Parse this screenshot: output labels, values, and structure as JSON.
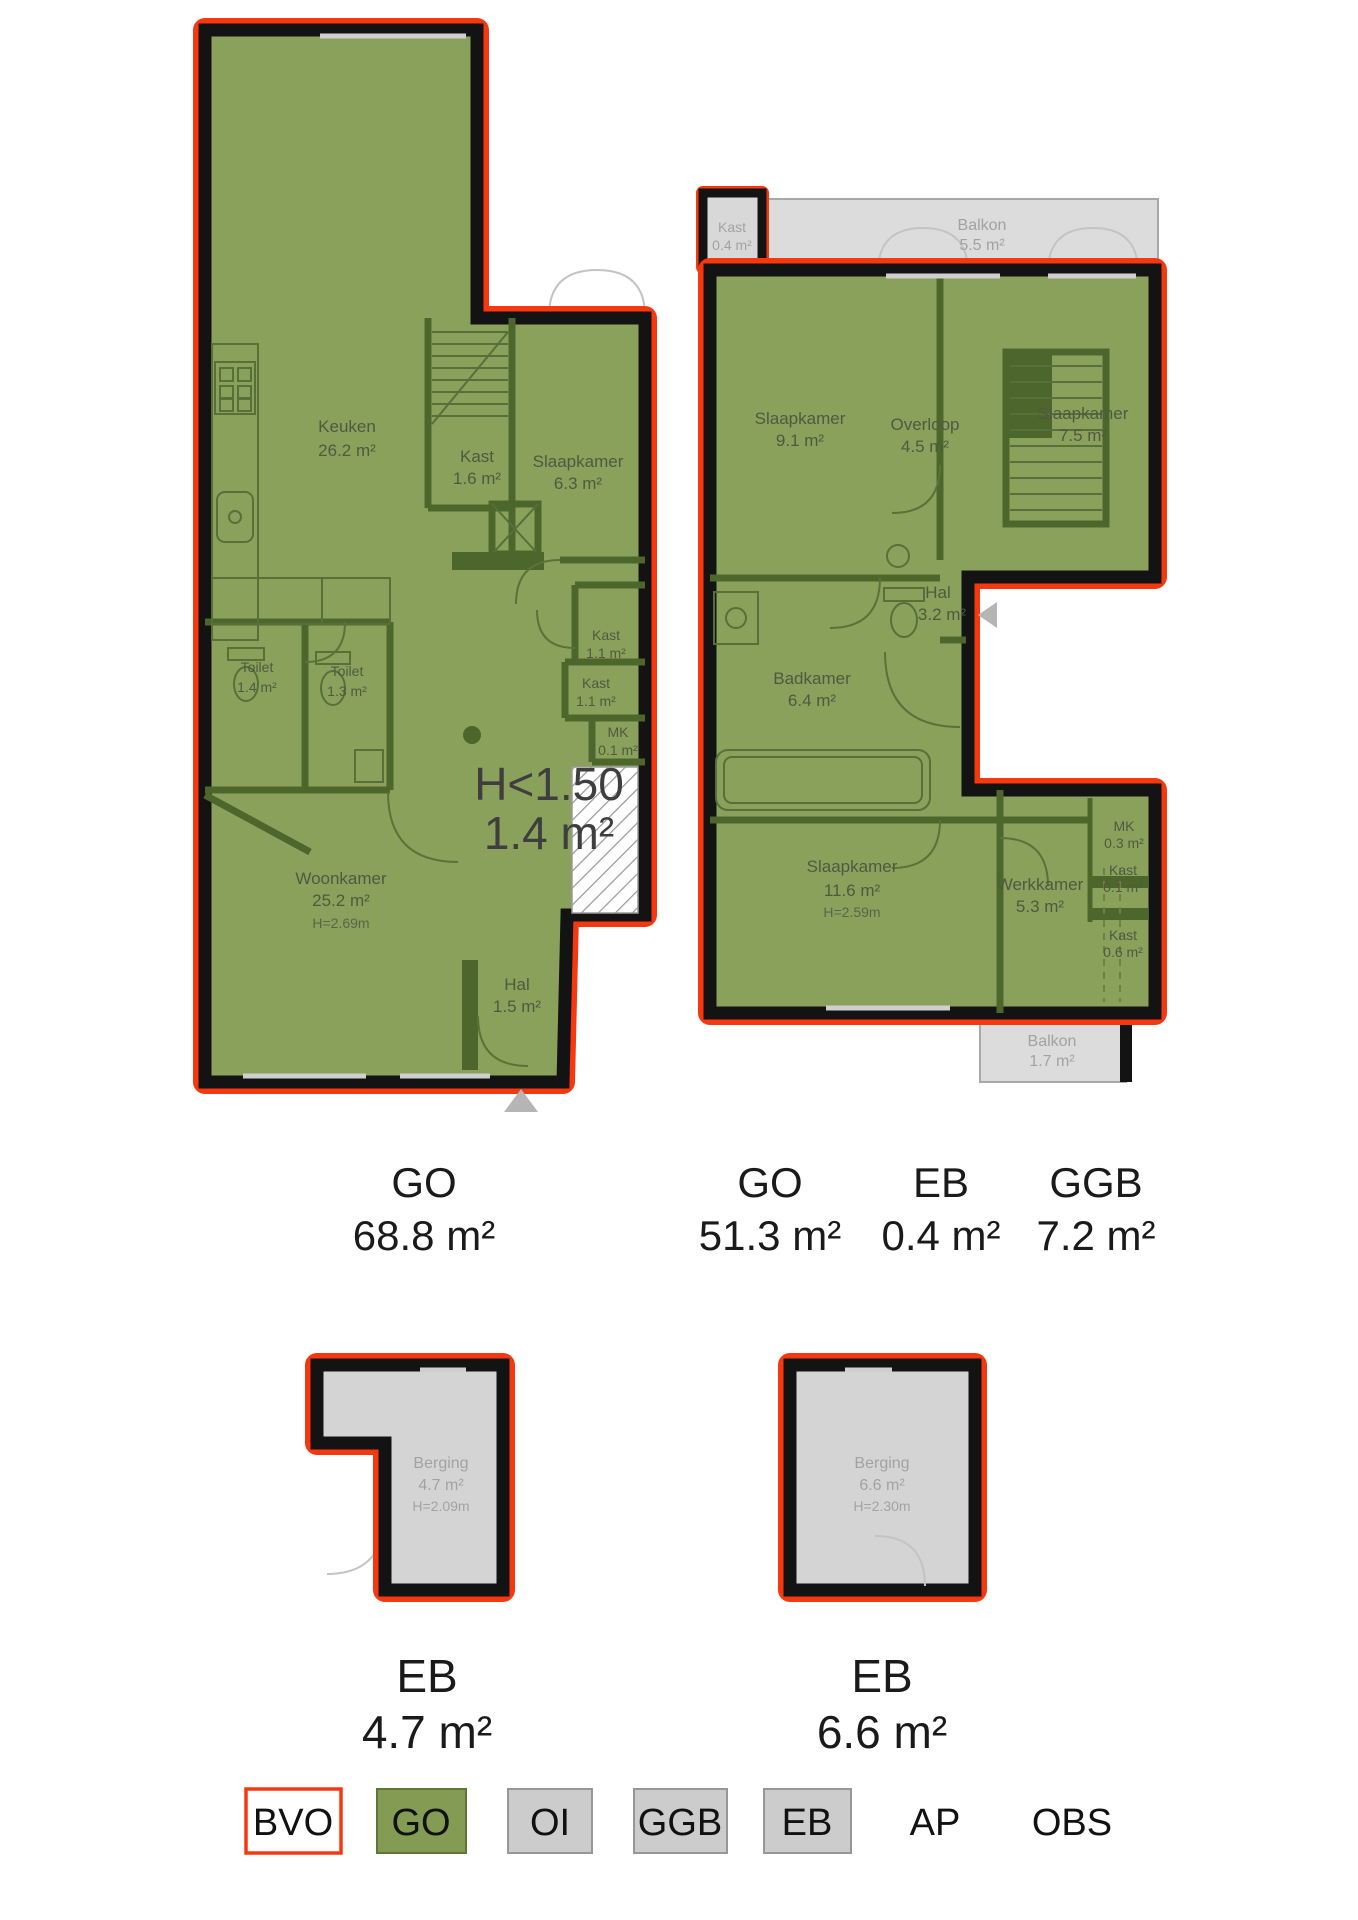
{
  "floor1": {
    "rooms": {
      "keuken": {
        "name": "Keuken",
        "area": "26.2 m²"
      },
      "kast_trap": {
        "name": "Kast",
        "area": "1.6 m²"
      },
      "slaapkamer": {
        "name": "Slaapkamer",
        "area": "6.3 m²"
      },
      "kast_a": {
        "name": "Kast",
        "area": "1.1 m²"
      },
      "kast_b": {
        "name": "Kast",
        "area": "1.1 m²"
      },
      "mk": {
        "name": "MK",
        "area": "0.1 m²"
      },
      "toilet_a": {
        "name": "Toilet",
        "area": "1.4 m²"
      },
      "toilet_b": {
        "name": "Toilet",
        "area": "1.3 m²"
      },
      "woonkamer": {
        "name": "Woonkamer",
        "area": "25.2 m²",
        "height": "H=2.69m"
      },
      "hal": {
        "name": "Hal",
        "area": "1.5 m²"
      },
      "laag": {
        "name": "H<1.50",
        "area": "1.4 m²"
      }
    }
  },
  "floor2": {
    "rooms": {
      "kast_buiten": {
        "name": "Kast",
        "area": "0.4 m²"
      },
      "balkon_voor": {
        "name": "Balkon",
        "area": "5.5 m²"
      },
      "slaapkamer_1": {
        "name": "Slaapkamer",
        "area": "9.1 m²"
      },
      "overloop": {
        "name": "Overloop",
        "area": "4.5 m²"
      },
      "slaapkamer_2": {
        "name": "Slaapkamer",
        "area": "7.5 m²"
      },
      "hal": {
        "name": "Hal",
        "area": "3.2 m²"
      },
      "badkamer": {
        "name": "Badkamer",
        "area": "6.4 m²"
      },
      "slaapkamer_3": {
        "name": "Slaapkamer",
        "area": "11.6 m²",
        "height": "H=2.59m"
      },
      "werkkamer": {
        "name": "Werkkamer",
        "area": "5.3 m²"
      },
      "mk": {
        "name": "MK",
        "area": "0.3 m²"
      },
      "kast_c": {
        "name": "Kast",
        "area": "0.1 m²"
      },
      "kast_d": {
        "name": "Kast",
        "area": "0.6 m²"
      },
      "balkon_achter": {
        "name": "Balkon",
        "area": "1.7 m²"
      }
    }
  },
  "storage1": {
    "name": "Berging",
    "area": "4.7 m²",
    "height": "H=2.09m"
  },
  "storage2": {
    "name": "Berging",
    "area": "6.6 m²",
    "height": "H=2.30m"
  },
  "area_labels": {
    "floor1_go": {
      "code": "GO",
      "value": "68.8 m²"
    },
    "floor2_go": {
      "code": "GO",
      "value": "51.3 m²"
    },
    "floor2_eb": {
      "code": "EB",
      "value": "0.4 m²"
    },
    "floor2_ggb": {
      "code": "GGB",
      "value": "7.2 m²"
    },
    "storage1_eb": {
      "code": "EB",
      "value": "4.7 m²"
    },
    "storage2_eb": {
      "code": "EB",
      "value": "6.6 m²"
    }
  },
  "legend": {
    "items": [
      {
        "label": "BVO",
        "swatch": "bvo"
      },
      {
        "label": "GO",
        "swatch": "go"
      },
      {
        "label": "OI",
        "swatch": "gray"
      },
      {
        "label": "GGB",
        "swatch": "gray"
      },
      {
        "label": "EB",
        "swatch": "gray"
      },
      {
        "label": "AP",
        "swatch": "none"
      },
      {
        "label": "OBS",
        "swatch": "none"
      }
    ]
  },
  "colors": {
    "bvo_outline": "#f5380f",
    "go_fill": "#8aa15c",
    "oi_fill": "#cdcdcd",
    "wall": "#131313"
  }
}
